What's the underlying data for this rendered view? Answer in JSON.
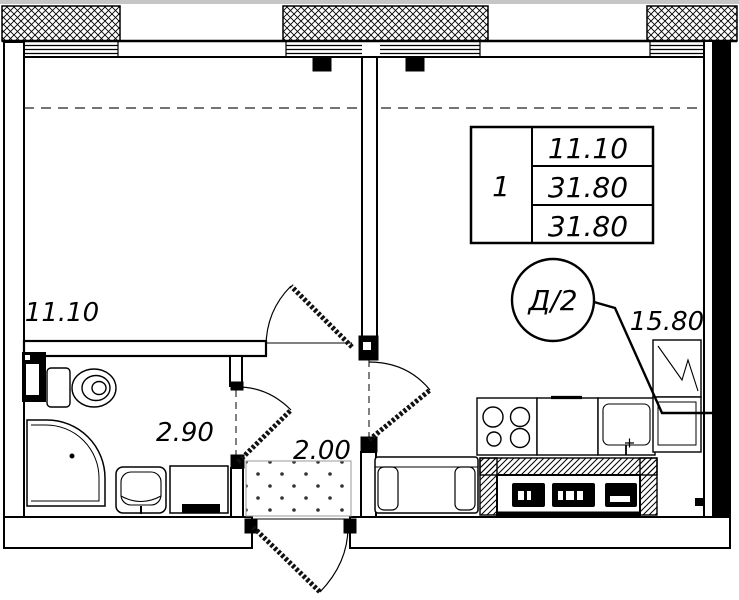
{
  "plan": {
    "rooms": {
      "room1": {
        "area": "11.10"
      },
      "bathroom": {
        "area": "2.90"
      },
      "hallway": {
        "area": "2.00"
      },
      "kitchen_living": {
        "area": "15.80"
      }
    },
    "stamp": {
      "rooms_count": "1",
      "values": [
        "11.10",
        "31.80",
        "31.80"
      ]
    },
    "badge": {
      "label": "Д/2"
    },
    "colors": {
      "ink": "#000000",
      "paper": "#ffffff"
    }
  }
}
